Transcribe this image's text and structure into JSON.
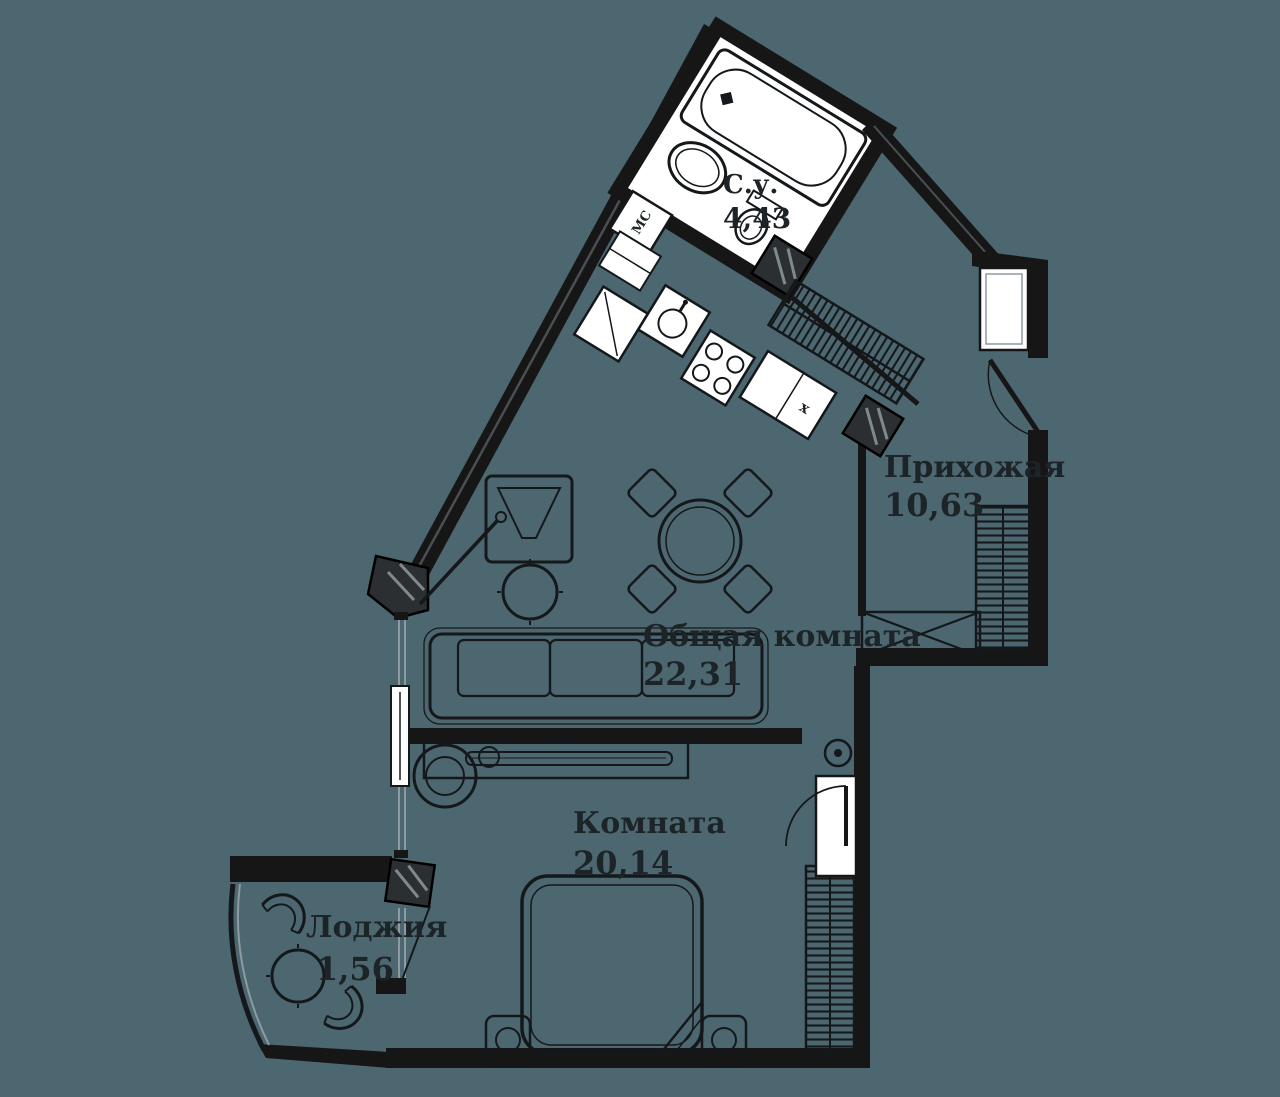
{
  "colors": {
    "background": "#4d6770",
    "walls": "#161616",
    "fixtures": "#ffffff"
  },
  "rooms": [
    {
      "id": "bathroom",
      "name": "С.у.",
      "area": "4,43"
    },
    {
      "id": "hallway",
      "name": "Прихожая",
      "area": "10,63"
    },
    {
      "id": "living_room",
      "name": "Общая комната",
      "area": "22,31"
    },
    {
      "id": "bedroom",
      "name": "Комната",
      "area": "20,14"
    },
    {
      "id": "loggia",
      "name": "Лоджия",
      "area": "1,56"
    }
  ],
  "annotations": {
    "washing_machine": "МС",
    "cabinet_mark": "x"
  }
}
